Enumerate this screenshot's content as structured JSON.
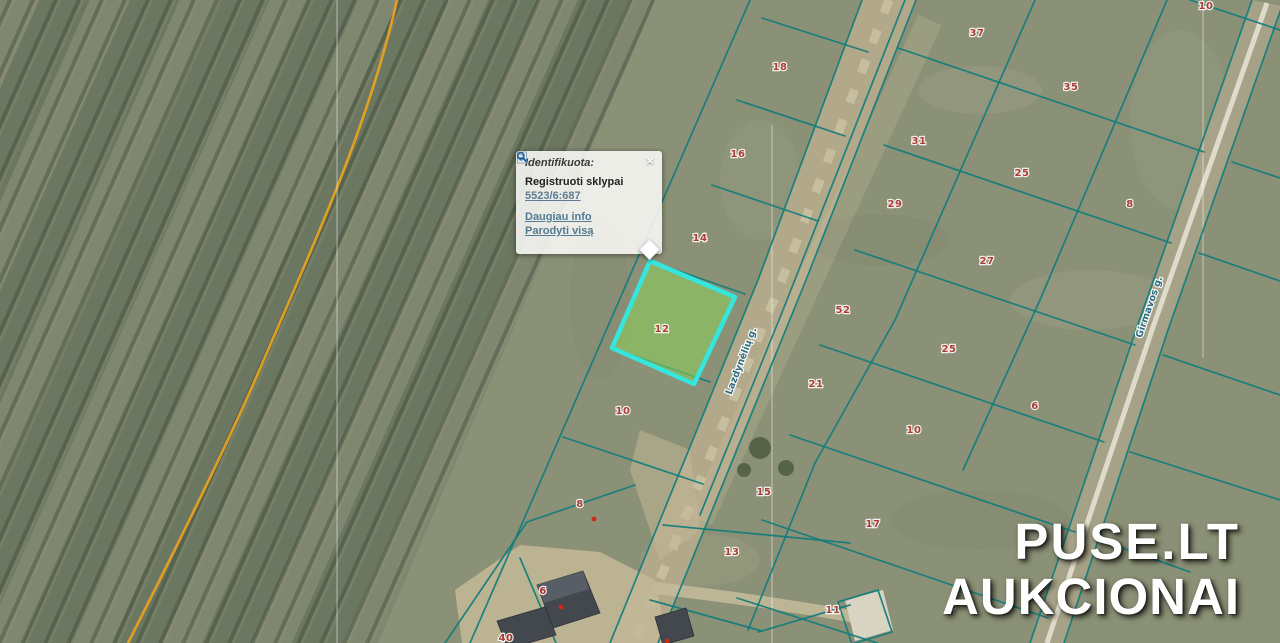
{
  "popup": {
    "title": "Identifikuota:",
    "close_label": "×",
    "layer_title": "Registruoti sklypai",
    "parcel_code": "5523/6:687",
    "links": [
      {
        "label": "Daugiau info"
      },
      {
        "label": "Parodyti visą"
      }
    ]
  },
  "watermark": {
    "line1": "PUSE.LT",
    "line2": "AUKCIONAI"
  },
  "map": {
    "colors": {
      "boundary_teal": "#117d7d",
      "highlight_stroke": "#35e6de",
      "highlight_fill": "rgba(140,210,90,0.55)",
      "parcel_label_red": "#b03228",
      "pipeline_orange": "#e8a21f",
      "street_label_teal": "#23677f"
    },
    "highlighted_parcel": {
      "label": "12"
    },
    "streets": [
      {
        "name": "Lazdynėlių g.",
        "x": 744,
        "y": 362,
        "rot": -69
      },
      {
        "name": "Girmavos g.",
        "x": 1152,
        "y": 308,
        "rot": -71
      }
    ],
    "parcels": [
      {
        "label": "18",
        "x": 780,
        "y": 70
      },
      {
        "label": "37",
        "x": 977,
        "y": 36
      },
      {
        "label": "10",
        "x": 1206,
        "y": 9
      },
      {
        "label": "16",
        "x": 738,
        "y": 157
      },
      {
        "label": "31",
        "x": 919,
        "y": 144
      },
      {
        "label": "35",
        "x": 1071,
        "y": 90
      },
      {
        "label": "25",
        "x": 1022,
        "y": 176
      },
      {
        "label": "8",
        "x": 1130,
        "y": 207
      },
      {
        "label": "29",
        "x": 895,
        "y": 207
      },
      {
        "label": "14",
        "x": 700,
        "y": 241
      },
      {
        "label": "27",
        "x": 987,
        "y": 264
      },
      {
        "label": "52",
        "x": 843,
        "y": 313
      },
      {
        "label": "12",
        "x": 662,
        "y": 332
      },
      {
        "label": "25",
        "x": 949,
        "y": 352
      },
      {
        "label": "21",
        "x": 816,
        "y": 387
      },
      {
        "label": "6",
        "x": 1035,
        "y": 409
      },
      {
        "label": "10",
        "x": 914,
        "y": 433
      },
      {
        "label": "10",
        "x": 623,
        "y": 414
      },
      {
        "label": "8",
        "x": 580,
        "y": 507
      },
      {
        "label": "15",
        "x": 764,
        "y": 495
      },
      {
        "label": "17",
        "x": 873,
        "y": 527
      },
      {
        "label": "13",
        "x": 732,
        "y": 555
      },
      {
        "label": "6",
        "x": 543,
        "y": 594
      },
      {
        "label": "11",
        "x": 833,
        "y": 613
      },
      {
        "label": "4",
        "x": 952,
        "y": 609
      },
      {
        "label": "40",
        "x": 506,
        "y": 641
      }
    ]
  }
}
